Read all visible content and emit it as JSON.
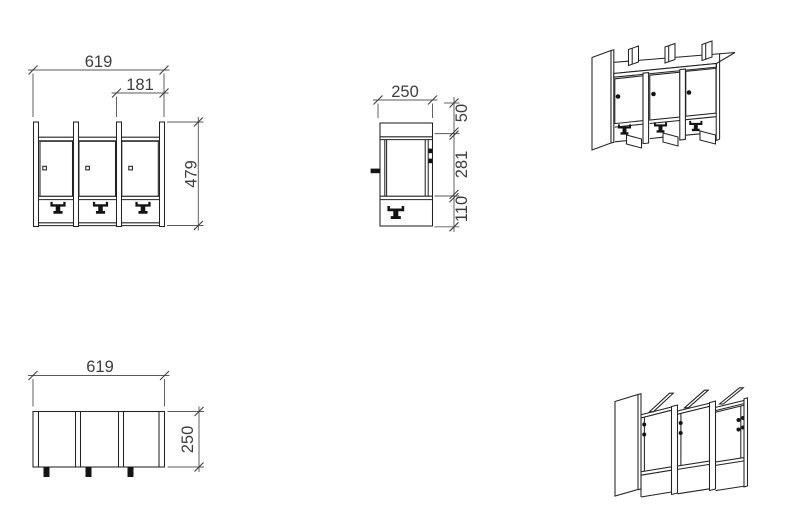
{
  "drawing": {
    "colors": {
      "background": "#ffffff",
      "object_line": "#232323",
      "dimension_line": "#5a5a5a",
      "dimension_text": "#3d3d3d",
      "hardware_black": "#141414"
    },
    "symbols": {
      "coat_hook": "anchor-hook-glyph",
      "door_knob": "square-knob",
      "hinge": "black-dot-pair"
    },
    "views": {
      "front": {
        "dims": {
          "total_width": "619",
          "right_bay_width": "181",
          "height": "479"
        }
      },
      "side": {
        "dims": {
          "depth": "250",
          "top": "50",
          "middle": "281",
          "bottom": "110"
        }
      },
      "plan": {
        "dims": {
          "width": "619",
          "depth": "250"
        }
      }
    }
  }
}
